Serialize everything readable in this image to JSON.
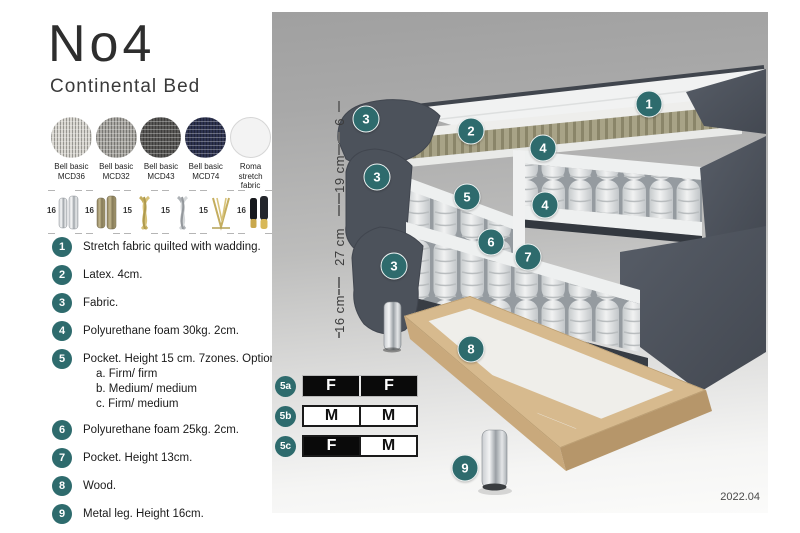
{
  "header": {
    "title": "No4",
    "subtitle": "Continental Bed"
  },
  "fabrics": [
    {
      "line1": "Bell basic",
      "line2": "MCD36"
    },
    {
      "line1": "Bell basic",
      "line2": "MCD32"
    },
    {
      "line1": "Bell basic",
      "line2": "MCD43"
    },
    {
      "line1": "Bell basic",
      "line2": "MCD74"
    },
    {
      "line1": "Roma",
      "line2": "stretch fabric"
    }
  ],
  "legs": [
    {
      "size": "16",
      "style": "cylinder-chrome"
    },
    {
      "size": "16",
      "style": "cylinder-wood"
    },
    {
      "size": "15",
      "style": "twisted-gold"
    },
    {
      "size": "15",
      "style": "twisted-silver"
    },
    {
      "size": "15",
      "style": "hairpin-gold"
    },
    {
      "size": "16",
      "style": "cylinder-black-gold"
    }
  ],
  "materials": {
    "items": [
      {
        "num": "1",
        "text": "Stretch fabric quilted with wadding."
      },
      {
        "num": "2",
        "text": "Latex. 4cm."
      },
      {
        "num": "3",
        "text": "Fabric."
      },
      {
        "num": "4",
        "text": "Polyurethane foam 30kg. 2cm."
      },
      {
        "num": "5",
        "text": "Pocket. Height 15 cm. 7zones. Option:",
        "options": [
          "a. Firm/ firm",
          "b. Medium/ medium",
          "c. Firm/ medium"
        ]
      },
      {
        "num": "6",
        "text": "Polyurethane foam 25kg. 2cm."
      },
      {
        "num": "7",
        "text": "Pocket. Height 13cm."
      },
      {
        "num": "8",
        "text": "Wood."
      },
      {
        "num": "9",
        "text": "Metal leg. Height 16cm."
      }
    ]
  },
  "diagram": {
    "dimensions": [
      "6",
      "19 cm",
      "27 cm",
      "16 cm"
    ],
    "badges": [
      "1",
      "2",
      "3",
      "3",
      "3",
      "4",
      "4",
      "5",
      "6",
      "7",
      "8",
      "9"
    ]
  },
  "firmness": {
    "rows": [
      {
        "id": "5a",
        "left": "F",
        "right": "F"
      },
      {
        "id": "5b",
        "left": "M",
        "right": "M"
      },
      {
        "id": "5c",
        "left": "F",
        "right": "M"
      }
    ]
  },
  "footer": {
    "version": "2022.04"
  },
  "colors": {
    "accent_teal": "#2E6B6D",
    "latex": "#a8a387",
    "wood": "#d9bd92",
    "fabric_dark": "#4c525b"
  }
}
